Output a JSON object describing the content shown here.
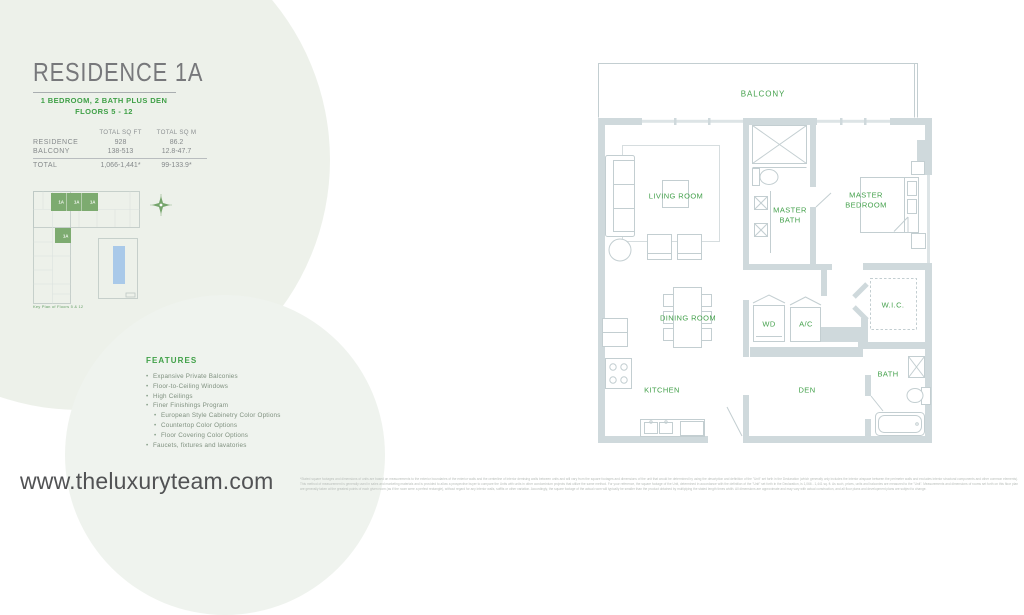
{
  "header": {
    "title": "RESIDENCE 1A",
    "subtitle_line1": "1 BEDROOM, 2 BATH PLUS DEN",
    "subtitle_line2": "FLOORS 5 - 12"
  },
  "area_table": {
    "col1_header": "TOTAL SQ FT",
    "col2_header": "TOTAL SQ M",
    "rows": [
      {
        "label": "RESIDENCE",
        "sqft": "928",
        "sqm": "86.2"
      },
      {
        "label": "BALCONY",
        "sqft": "138-513",
        "sqm": "12.8-47.7"
      }
    ],
    "total": {
      "label": "TOTAL",
      "sqft": "1,066-1,441*",
      "sqm": "99-133.9*"
    }
  },
  "key_plan": {
    "caption": "Key Plan of Floors 5 & 12",
    "units": [
      "1A",
      "1A",
      "1A",
      "1A"
    ]
  },
  "features": {
    "heading": "FEATURES",
    "items": [
      {
        "text": "Expansive Private Balconies",
        "level": 1
      },
      {
        "text": "Floor-to-Ceiling Windows",
        "level": 1
      },
      {
        "text": "High Ceilings",
        "level": 1
      },
      {
        "text": "Finer Finishings Program",
        "level": 1
      },
      {
        "text": "European Style Cabinetry Color Options",
        "level": 2
      },
      {
        "text": "Countertop Color Options",
        "level": 2
      },
      {
        "text": "Floor Covering Color Options",
        "level": 2
      },
      {
        "text": "Faucets, fixtures and lavatories",
        "level": 1
      }
    ]
  },
  "floor_plan": {
    "labels": [
      {
        "id": "balcony",
        "text": "BALCONY"
      },
      {
        "id": "living-room",
        "text": "LIVING ROOM"
      },
      {
        "id": "master-bath",
        "text": "MASTER BATH"
      },
      {
        "id": "master-bedroom",
        "text": "MASTER BEDROOM"
      },
      {
        "id": "dining-room",
        "text": "DINING ROOM"
      },
      {
        "id": "wd",
        "text": "WD"
      },
      {
        "id": "ac",
        "text": "A/C"
      },
      {
        "id": "wic",
        "text": "W.I.C."
      },
      {
        "id": "kitchen",
        "text": "KITCHEN"
      },
      {
        "id": "den",
        "text": "DEN"
      },
      {
        "id": "bath",
        "text": "BATH"
      }
    ]
  },
  "footer": {
    "website": "www.theluxuryteam.com",
    "disclaimer": "*Stated square footages and dimensions of units are based on measurements to the exterior boundaries of the exterior walls and the centerline of interior demising walls between units and will vary from the square footages and dimensions of the unit that would be determined by using the description and definition of the \"Unit\" set forth in the Declaration (which generally only includes the interior airspace between the perimeter walls and excludes interior structural components and other common elements). This method of measurement is generally used in sales and marketing materials and is provided to allow a prospective buyer to compare the Units with units in other condominium projects that utilize the same method. For your reference, the square footage of the Unit, determined in accordance with the definition of the \"Unit\" set forth in the Declaration, is 1,066 - 1,441 sq. ft. As such, prices, units and balconies are measured to the \"Unit\". Measurements and dimensions of rooms set forth on this floor plan are generally taken at the greatest points of each given room (as if the room were a perfect rectangle), without regard for any interior walls, soffits or other variation. Accordingly, the square footage of the actual room will typically be smaller than the product obtained by multiplying the stated length times width. All dimensions are approximate and may vary with actual construction, and all floor plans and development plans are subject to change."
  },
  "colors": {
    "accent_green": "#3fa047",
    "key_plan_unit_green": "#7dab70",
    "wall_gray": "#cfd9dc",
    "pool_blue": "#a9c9e9",
    "title_gray": "#77787b",
    "body_gray": "#85898b"
  }
}
